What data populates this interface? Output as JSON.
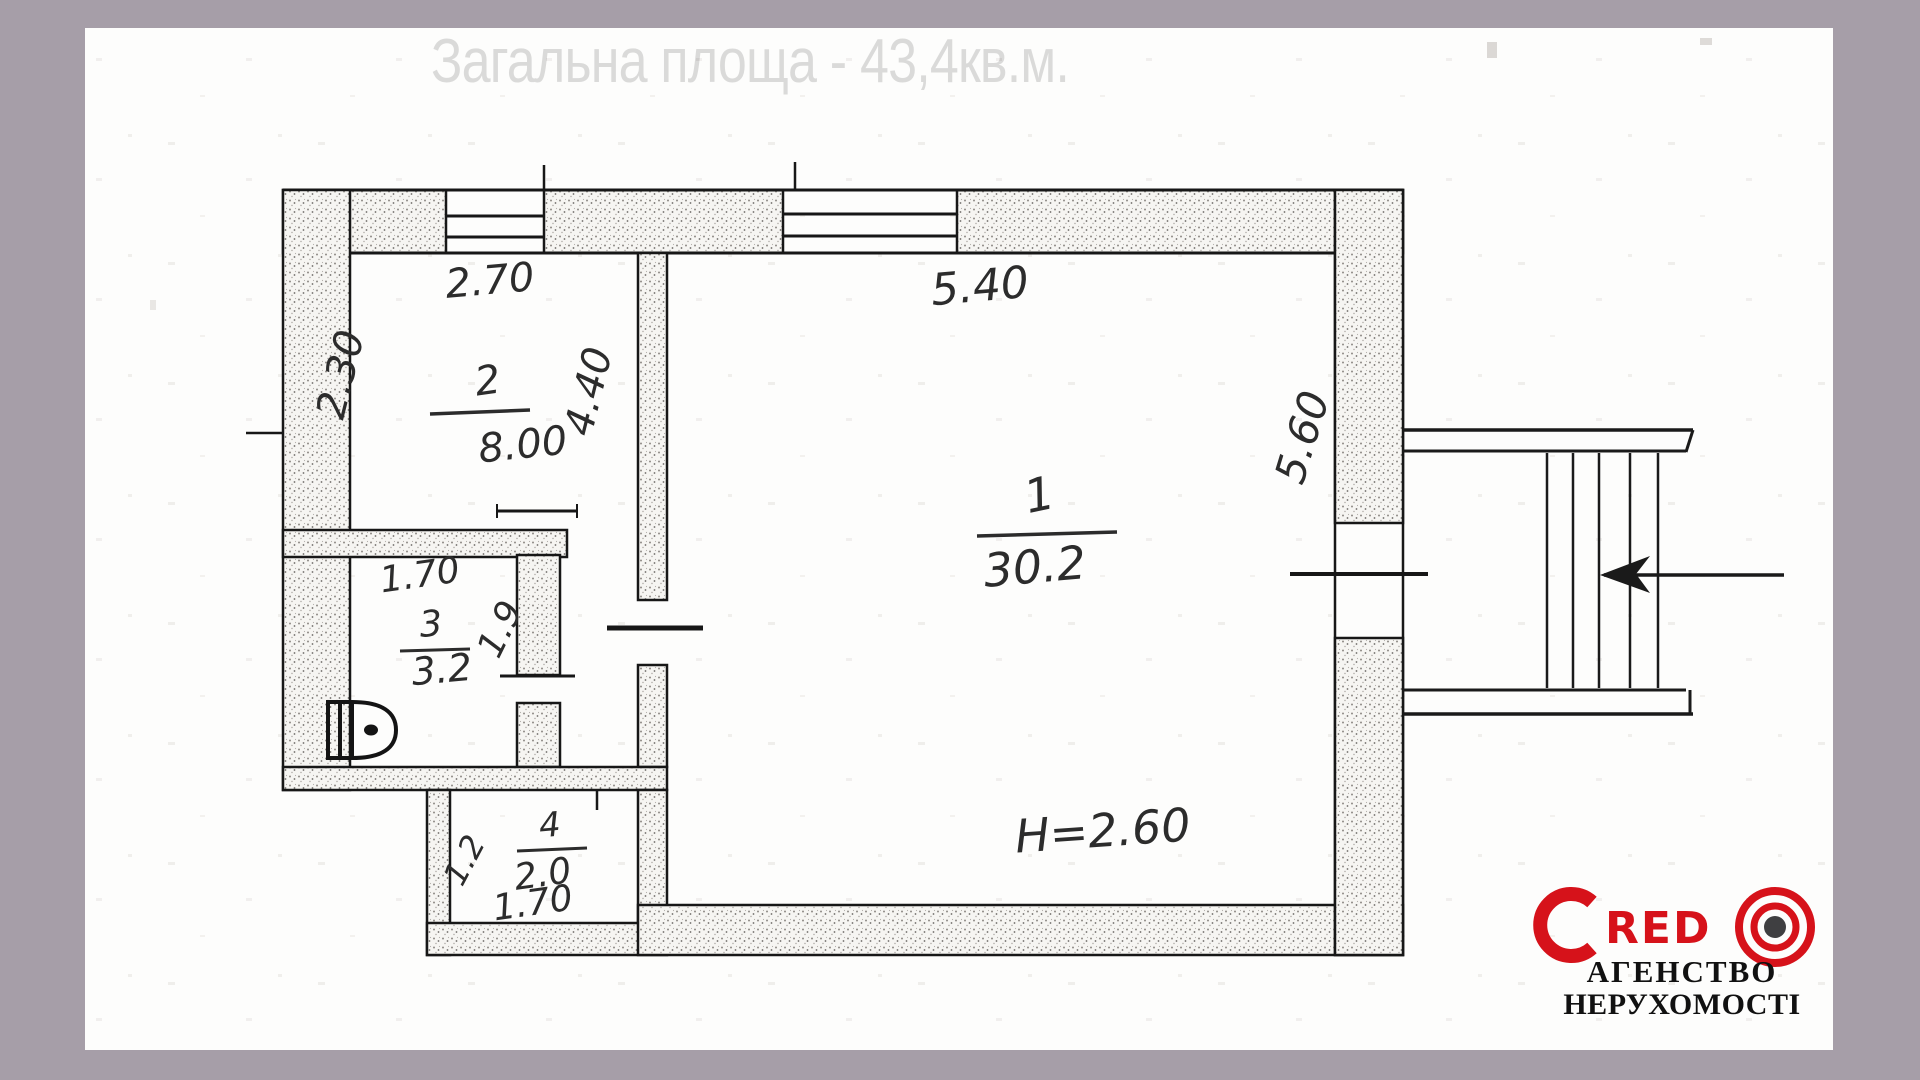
{
  "page": {
    "title": "Загальна площа - 43,4кв.м."
  },
  "plan": {
    "rooms": [
      {
        "number": "1",
        "area": "30.2"
      },
      {
        "number": "2",
        "area": "8.00"
      },
      {
        "number": "3",
        "area": "3.2"
      },
      {
        "number": "4",
        "area": "2.0"
      }
    ],
    "dimensions": {
      "room2_width": "2.70",
      "room2_depth": "2.30",
      "room2_right": "4.40",
      "room1_width": "5.40",
      "room1_depth": "5.60",
      "room3_width": "1.70",
      "room3_depth": "1.9",
      "room4_width": "1.70",
      "room4_depth": "1.2",
      "ceiling_height": "H=2.60"
    }
  },
  "logo": {
    "name_c": "C",
    "name_red": "RED",
    "agency_line1": "АГЕНСТВО",
    "agency_line2": "НЕРУХОМОСТІ"
  }
}
